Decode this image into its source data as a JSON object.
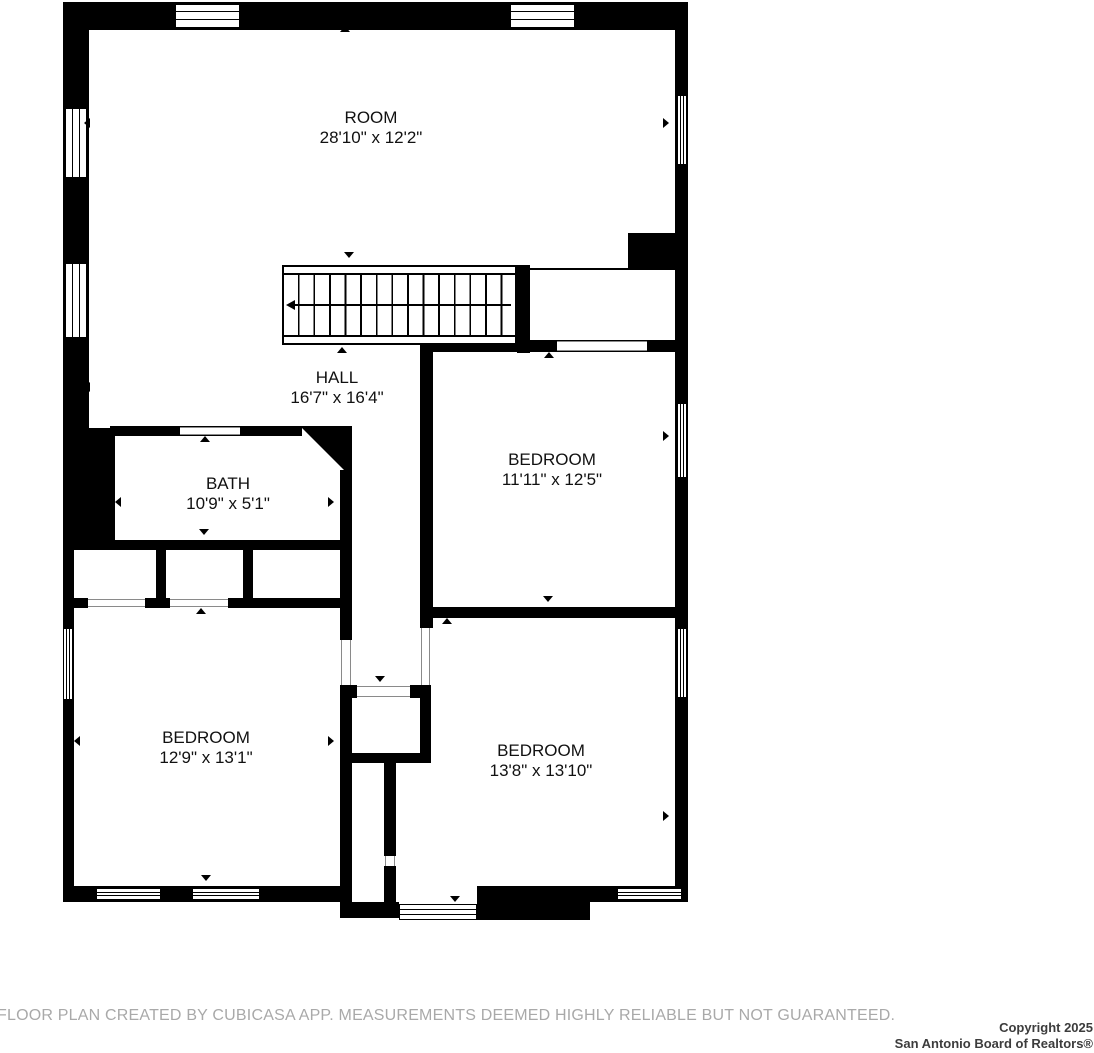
{
  "rooms": [
    {
      "name": "ROOM",
      "dims": "28'10\" x 12'2\""
    },
    {
      "name": "HALL",
      "dims": "16'7\" x 16'4\""
    },
    {
      "name": "BATH",
      "dims": "10'9\" x 5'1\""
    },
    {
      "name": "BEDROOM",
      "dims": "11'11\" x 12'5\""
    },
    {
      "name": "BEDROOM",
      "dims": "12'9\" x 13'1\""
    },
    {
      "name": "BEDROOM",
      "dims": "13'8\" x 13'10\""
    }
  ],
  "footer": {
    "disclaimer": "FLOOR PLAN CREATED BY CUBICASA APP. MEASUREMENTS DEEMED HIGHLY RELIABLE BUT NOT GUARANTEED.",
    "copyright_line1": "Copyright 2025",
    "copyright_line2": "San Antonio Board of Realtors®"
  },
  "colors": {
    "wall": "#000000",
    "label": "#111111",
    "disclaimer": "#a9a9a9"
  }
}
